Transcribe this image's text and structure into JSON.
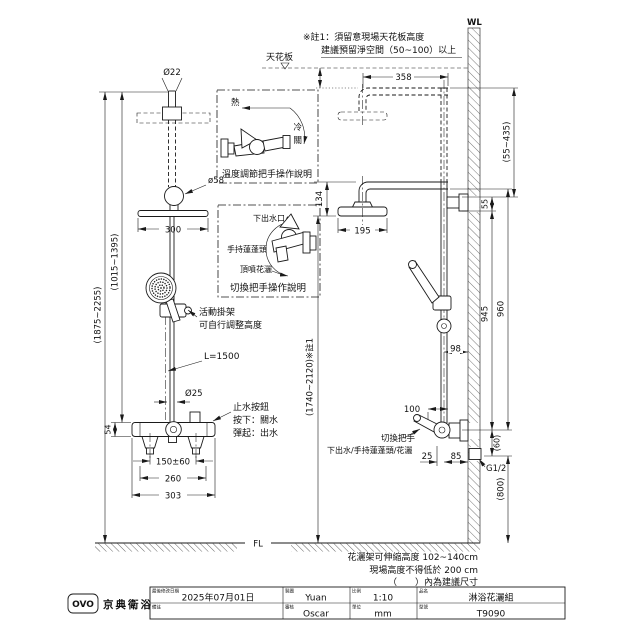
{
  "front_view": {
    "dia_top_pipe": "Ø22",
    "dia_elbow": "ø58",
    "dim_head_width": "300",
    "note_bracket_1": "活動掛架",
    "note_bracket_2": "可自行調整高度",
    "hose_length": "L=1500",
    "dia_bar": "Ø25",
    "note_button_1": "止水按鈕",
    "note_button_2": "按下：關水",
    "note_button_3": "彈起：出水",
    "dim_valve_body": "54",
    "dim_inlet_span": "150±60",
    "dim_valve_width": "260",
    "dim_overall_width": "303",
    "dim_height_head_range": "(1015~1395)",
    "dim_height_total_range": "(1875~2255)",
    "floor_label": "FL"
  },
  "ceiling": {
    "label": "天花板",
    "note_line1": "※註1：須留意現場天花板高度",
    "note_line2": "建議預留淨空間（50~100）以上"
  },
  "temp_box": {
    "hot": "熱",
    "cold": "冷",
    "off": "關",
    "caption": "溫度調節把手操作說明"
  },
  "switch_box": {
    "bottom_outlet": "下出水口",
    "hand_shower": "手持蓮蓬頭",
    "top_shower": "頂噴花灑",
    "caption": "切換把手操作說明"
  },
  "side_view": {
    "wall_label": "WL",
    "dim_arm_reach": "358",
    "dim_drop_range": "(55~435)",
    "dim_head_drop": "134",
    "dim_head_dia": "195",
    "dim_bracket": "55",
    "dim_pipe_wall": "98",
    "dim_height_range": "(1740~2120)※註1",
    "dim_945": "945",
    "dim_960": "960",
    "dim_handle": "100",
    "label_switch_handle": "切換把手",
    "label_outlets": "下出水/手持蓮蓬頭/花灑",
    "dim_25": "25",
    "dim_85": "85",
    "dim_60": "(60)",
    "thread_label": "G1/2",
    "dim_800": "(800)"
  },
  "notes": {
    "line1": "花灑架可伸縮高度 102~140cm",
    "line2": "現場高度不得低於 200 cm",
    "line3": "（　　）內為建議尺寸"
  },
  "title_block": {
    "logo_text": "OVO",
    "brand": "京典衛浴",
    "date_label": "最後修改日期",
    "date": "2025年07月01日",
    "remark_label": "備註",
    "remark": "",
    "drafter_label": "製圖",
    "drafter": "Yuan",
    "checker_label": "審核",
    "checker": "Oscar",
    "scale_label": "比例",
    "scale": "1:10",
    "unit_label": "單位",
    "unit": "mm",
    "product_label": "品名",
    "product": "淋浴花灑組",
    "model_label": "型號",
    "model": "T9090"
  }
}
